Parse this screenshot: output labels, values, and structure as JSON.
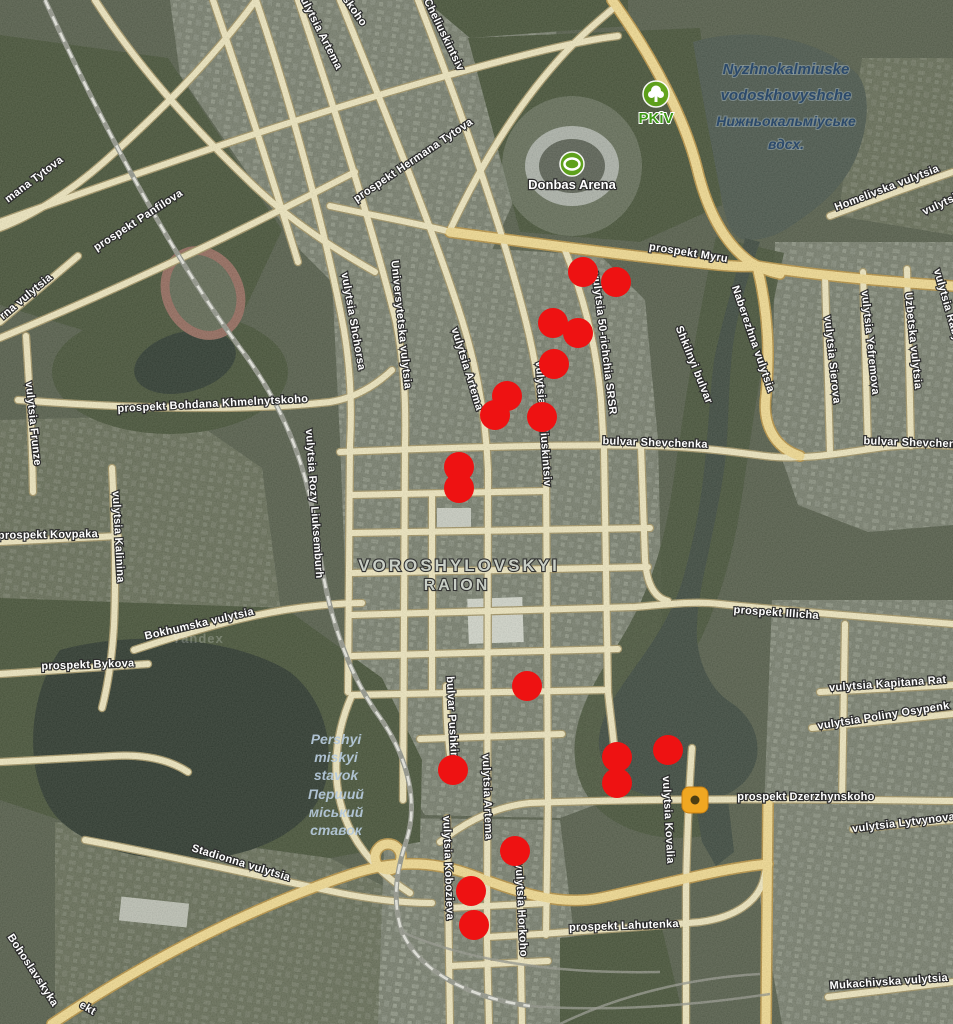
{
  "map": {
    "colors": {
      "road_minor": "#efe5bd",
      "road_minor_casing": "#9c8c5d",
      "road_major": "#f2d88c",
      "road_major_casing": "#b28a3a",
      "water": "#303c33",
      "marker_red": "#ee1212",
      "marker_orange": "#f0a722",
      "marker_orange_center": "#4c3d12",
      "poi_green": "#5ea319"
    },
    "labels": [
      {
        "t": "prospekt Hermana Tytova",
        "x": 415,
        "y": 163,
        "r": -34
      },
      {
        "t": "mana Tytova",
        "x": 36,
        "y": 182,
        "r": -37
      },
      {
        "t": "prospekt Panfilova",
        "x": 140,
        "y": 223,
        "r": -33
      },
      {
        "t": "vulytsia Artema",
        "x": 317,
        "y": 32,
        "r": 63
      },
      {
        "t": "skoho",
        "x": 352,
        "y": 13,
        "r": 55
      },
      {
        "t": "Cheliuskintsiv",
        "x": 441,
        "y": 36,
        "r": 64
      },
      {
        "t": "prospekt Myru",
        "x": 688,
        "y": 256,
        "r": 9
      },
      {
        "t": "Homelivska vulytsia",
        "x": 888,
        "y": 191,
        "r": -21
      },
      {
        "t": "vulytsia",
        "x": 944,
        "y": 206,
        "r": -25
      },
      {
        "t": "Nyzhnokalmiuske",
        "x": 786,
        "y": 74,
        "c": "waterdark",
        "s": 15
      },
      {
        "t": "vodoskhovyshche",
        "x": 786,
        "y": 100,
        "c": "waterdark",
        "s": 15
      },
      {
        "t": "Нижньокальміуське",
        "x": 786,
        "y": 126,
        "c": "waterdark",
        "s": 14
      },
      {
        "t": "вдсх.",
        "x": 786,
        "y": 149,
        "c": "waterdark",
        "s": 14
      },
      {
        "t": "PKiV",
        "x": 656,
        "y": 123,
        "c": "poigreen",
        "s": 15
      },
      {
        "t": "Donbas Arena",
        "x": 572,
        "y": 189,
        "c": "poiwhite",
        "s": 13
      },
      {
        "t": "vulytsia 50-richchia SRSR",
        "x": 601,
        "y": 344,
        "r": 83
      },
      {
        "t": "Shkilnyi bulvar",
        "x": 691,
        "y": 366,
        "r": 68
      },
      {
        "t": "Naberezhna vulytsia",
        "x": 750,
        "y": 340,
        "r": 71
      },
      {
        "t": "vulytsia Sierova",
        "x": 829,
        "y": 360,
        "r": 84
      },
      {
        "t": "vulytsia Yefremova",
        "x": 867,
        "y": 343,
        "r": 84
      },
      {
        "t": "Uzbetska vulytsia",
        "x": 910,
        "y": 341,
        "r": 84
      },
      {
        "t": "vulytsia Raby",
        "x": 944,
        "y": 306,
        "r": 74
      },
      {
        "t": "bulvar Shevchenka",
        "x": 655,
        "y": 446,
        "r": 2
      },
      {
        "t": "bulvar Shevchenka",
        "x": 916,
        "y": 446,
        "r": 2
      },
      {
        "t": "vulytsia Shchorsa",
        "x": 350,
        "y": 322,
        "r": 80
      },
      {
        "t": "Universytetska vulytsia",
        "x": 398,
        "y": 325,
        "r": 84
      },
      {
        "t": "vulytsia Artema",
        "x": 464,
        "y": 370,
        "r": 73
      },
      {
        "t": "vulytsia Cheliuskintsiv",
        "x": 540,
        "y": 424,
        "r": 86
      },
      {
        "t": "vulytsia Rozy Liuksemburh",
        "x": 311,
        "y": 504,
        "r": 86
      },
      {
        "t": "prospekt Bohdana Khmelnytskoho",
        "x": 213,
        "y": 407,
        "r": -3
      },
      {
        "t": "rna vulytsia",
        "x": 28,
        "y": 299,
        "r": -40
      },
      {
        "t": "vulytsia Frunze",
        "x": 30,
        "y": 424,
        "r": 84
      },
      {
        "t": "prospekt Kovpaka",
        "x": 48,
        "y": 538,
        "r": -1
      },
      {
        "t": "vulytsia Kalinina",
        "x": 115,
        "y": 537,
        "r": 87
      },
      {
        "t": "Bokhumska vulytsia",
        "x": 200,
        "y": 627,
        "r": -13
      },
      {
        "t": "prospekt Bykova",
        "x": 88,
        "y": 668,
        "r": -2
      },
      {
        "t": "VOROSHYLOVSKYI",
        "x": 459,
        "y": 571,
        "c": "district",
        "s": 17
      },
      {
        "t": "RAION",
        "x": 457,
        "y": 590,
        "c": "district",
        "s": 16
      },
      {
        "t": "prospekt Illicha",
        "x": 776,
        "y": 616,
        "r": 4
      },
      {
        "t": "vulytsia Kapitana Rat",
        "x": 888,
        "y": 687,
        "r": -4
      },
      {
        "t": "vulytsia Poliny Osypenk",
        "x": 884,
        "y": 719,
        "r": -9
      },
      {
        "t": "Pershyi",
        "x": 336,
        "y": 744,
        "c": "waterlight",
        "s": 14
      },
      {
        "t": "miskyi",
        "x": 336,
        "y": 762,
        "c": "waterlight",
        "s": 14
      },
      {
        "t": "stavok",
        "x": 336,
        "y": 780,
        "c": "waterlight",
        "s": 14
      },
      {
        "t": "Перший",
        "x": 336,
        "y": 799,
        "c": "waterlight",
        "s": 14
      },
      {
        "t": "міський",
        "x": 336,
        "y": 817,
        "c": "waterlight",
        "s": 14
      },
      {
        "t": "ставок",
        "x": 336,
        "y": 835,
        "c": "waterlight",
        "s": 14
      },
      {
        "t": "bulvar Pushkina",
        "x": 449,
        "y": 721,
        "r": 87
      },
      {
        "t": "vulytsia Artema",
        "x": 484,
        "y": 797,
        "r": 88
      },
      {
        "t": "vulytsia Kovalia",
        "x": 665,
        "y": 820,
        "r": 87
      },
      {
        "t": "prospekt Dzerzhynskoho",
        "x": 806,
        "y": 800,
        "r": 0
      },
      {
        "t": "vulytsia Lytvynova",
        "x": 904,
        "y": 826,
        "r": -7
      },
      {
        "t": "prospekt Lahutenka",
        "x": 624,
        "y": 929,
        "r": -2
      },
      {
        "t": "vulytsia Kobozieva",
        "x": 445,
        "y": 868,
        "r": 88
      },
      {
        "t": "vulytsia Horkoho",
        "x": 518,
        "y": 910,
        "r": 87
      },
      {
        "t": "Stadionna vulytsia",
        "x": 240,
        "y": 866,
        "r": 17
      },
      {
        "t": "Mukachivska vulytsia",
        "x": 889,
        "y": 985,
        "r": -4
      },
      {
        "t": "Bohoslavskyka",
        "x": 30,
        "y": 972,
        "r": 57
      },
      {
        "t": "ekt",
        "x": 86,
        "y": 1011,
        "r": 30
      }
    ],
    "watermark": {
      "text": "Yandex",
      "x": 198,
      "y": 643
    },
    "markers": {
      "red_dots": [
        [
          583,
          272
        ],
        [
          616,
          282
        ],
        [
          553,
          323
        ],
        [
          578,
          333
        ],
        [
          554,
          364
        ],
        [
          507,
          396
        ],
        [
          495,
          415
        ],
        [
          542,
          417
        ],
        [
          459,
          467
        ],
        [
          459,
          488
        ],
        [
          527,
          686
        ],
        [
          453,
          770
        ],
        [
          617,
          757
        ],
        [
          668,
          750
        ],
        [
          617,
          783
        ],
        [
          515,
          851
        ],
        [
          471,
          891
        ],
        [
          474,
          925
        ]
      ],
      "red_dot_radius": 15,
      "orange_marker": {
        "x": 695,
        "y": 800
      },
      "poi": [
        {
          "icon": "park-icon",
          "x": 656,
          "y": 94
        },
        {
          "icon": "stadium-icon",
          "x": 572,
          "y": 164
        }
      ]
    }
  }
}
